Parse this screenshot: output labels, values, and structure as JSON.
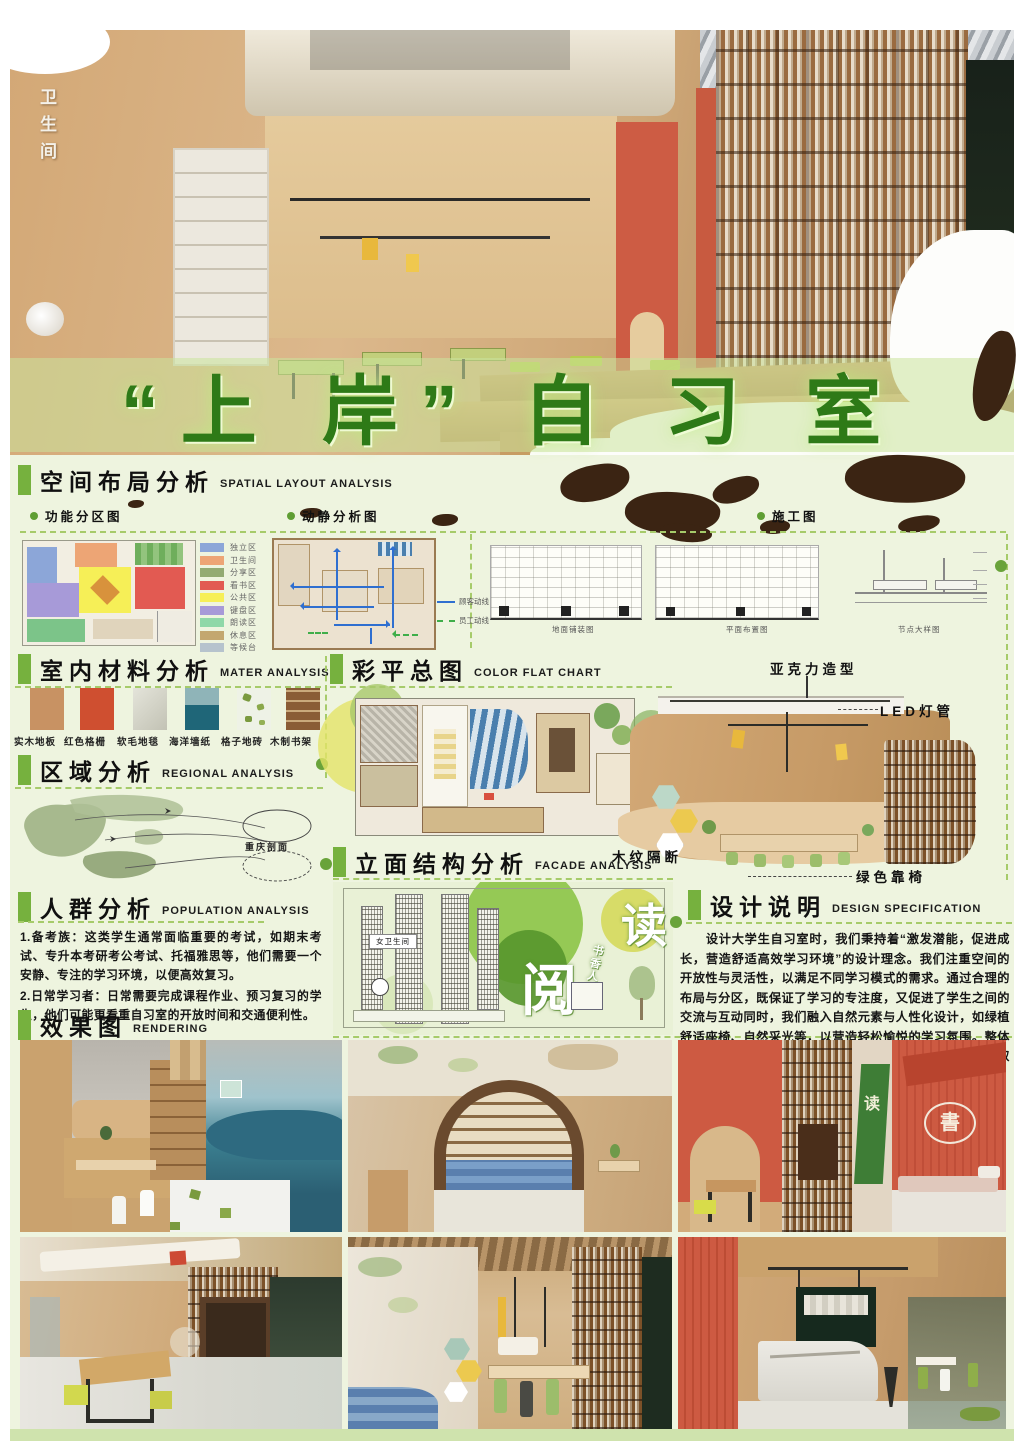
{
  "title": {
    "text": "“上 岸”  自 习 室"
  },
  "hero": {
    "wall_sign": "卫生间"
  },
  "spatial": {
    "zh": "空间布局分析",
    "en": "SPATIAL LAYOUT ANALYSIS"
  },
  "zone_plan": {
    "label": "功能分区图",
    "legend": [
      {
        "label": "独立区",
        "color": "#8ca6d8"
      },
      {
        "label": "卫生间",
        "color": "#eda575"
      },
      {
        "label": "分享区",
        "color": "#93ab72"
      },
      {
        "label": "看书区",
        "color": "#e25a52"
      },
      {
        "label": "公共区",
        "color": "#f6ef57"
      },
      {
        "label": "键盘区",
        "color": "#a79ad8"
      },
      {
        "label": "朗读区",
        "color": "#8fd8a8"
      },
      {
        "label": "休息区",
        "color": "#c3a76f"
      },
      {
        "label": "等候台",
        "color": "#b6c3cd"
      }
    ]
  },
  "circulation": {
    "label": "动静分析图",
    "legend": [
      {
        "label": "顾客动线",
        "color": "#2f6fd0"
      },
      {
        "label": "员工动线",
        "color": "#3fae4a"
      }
    ]
  },
  "construction": {
    "label": "施工图",
    "captions": [
      "地面铺装图",
      "平面布置图",
      "节点大样图"
    ]
  },
  "materials": {
    "zh": "室内材料分析",
    "en": "MATER ANALYSIS",
    "items": [
      {
        "label": "实木地板",
        "color": "#c89263"
      },
      {
        "label": "红色格栅",
        "color": "#cf4f30"
      },
      {
        "label": "软毛地毯",
        "color": "#d8d8ce"
      },
      {
        "label": "海洋墙纸",
        "color": "#2f7e93"
      },
      {
        "label": "格子地砖",
        "color": "#eef2e6"
      },
      {
        "label": "木制书架",
        "color": "#8a5c36"
      }
    ]
  },
  "regional": {
    "zh": "区域分析",
    "en": "REGIONAL ANALYSIS",
    "map_label": "重庆剖面"
  },
  "population": {
    "zh": "人群分析",
    "en": "POPULATION ANALYSIS",
    "p1": "1.备考族：这类学生通常面临重要的考试，如期末考试、专升本考研考公考试、托福雅思等，他们需要一个安静、专注的学习环境，以便高效复习。",
    "p2": "2.日常学习者：日常需要完成课程作业、预习复习的学生，他们可能更看重自习室的开放时间和交通便利性。"
  },
  "render_sec": {
    "zh": "效果图",
    "en": "RENDERING"
  },
  "colorflat": {
    "zh": "彩平总图",
    "en": "COLOR FLAT CHART"
  },
  "facade": {
    "zh": "立面结构分析",
    "en": "FACADE ANALYSIS",
    "big1": "读",
    "big2": "阅",
    "side_text": "书香人生",
    "sign": "女卫生间"
  },
  "axon": {
    "a1": "亚克力造型",
    "a2": "LED灯管",
    "a3": "木纹隔断",
    "a4": "绿色靠椅"
  },
  "design": {
    "zh": "设计说明",
    "en": "DESIGN SPECIFICATION",
    "body": "　　设计大学生自习室时，我们秉持着“激发潜能，促进成长，营造舒适高效学习环境”的设计理念。我们注重空间的开放性与灵活性，以满足不同学习模式的需求。通过合理的布局与分区，既保证了学习的专注度，又促进了学生之间的交流与互动同时，我们融入自然元素与人性化设计，如绿植舒适座椅、自然采光等，以营造轻松愉悦的学习氛围。整体设计旨在激发学生的创造力与求知欲助力他们在自习室中取得更好的学习成果。"
  },
  "colors": {
    "accent": "#76b13e",
    "title_green": "#2e7a17",
    "dash": "#a6cb6a"
  }
}
